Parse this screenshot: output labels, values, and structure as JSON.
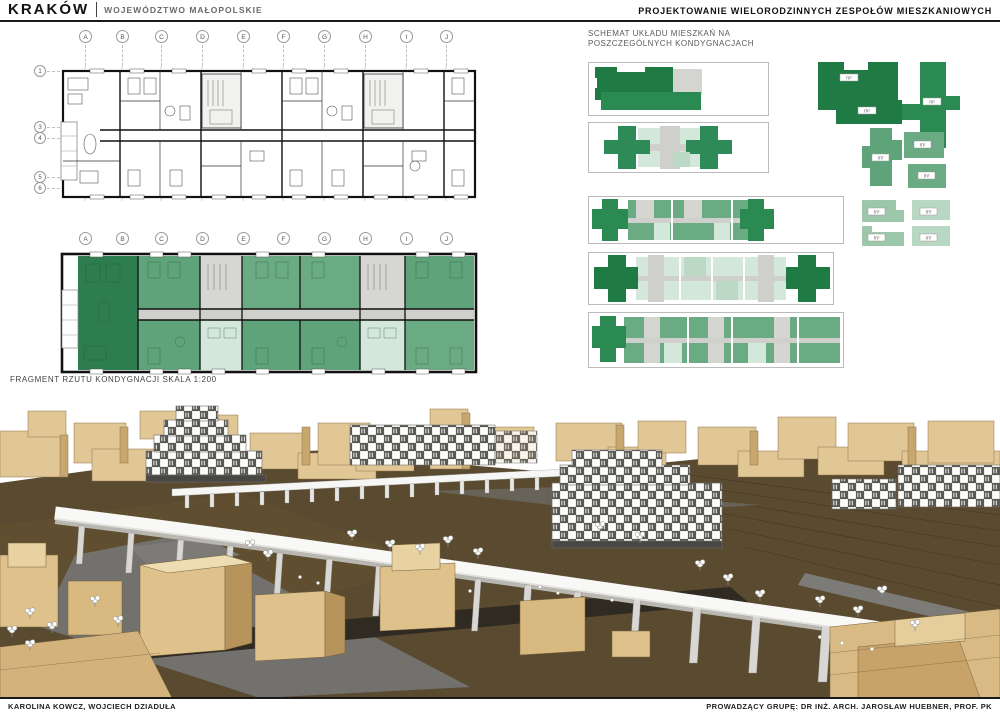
{
  "header": {
    "city": "KRAKÓW",
    "region": "WOJEWÓDZTWO MAŁOPOLSKIE",
    "course_title": "PROJEKTOWANIE WIELORODZINNYCH ZESPOŁÓW MIESZKANIOWYCH"
  },
  "plans": {
    "grid_columns": [
      "A",
      "B",
      "C",
      "D",
      "E",
      "F",
      "G",
      "H",
      "I",
      "J"
    ],
    "grid_rows": [
      "1",
      "3",
      "4",
      "5",
      "6"
    ],
    "caption": "FRAGMENT RZUTU KONDYGNACJI   SKALA 1:200"
  },
  "schematics": {
    "title_line1": "SCHEMAT UKŁADU MIESZKAŃ NA",
    "title_line2": "POSZCZEGÓLNYCH KONDYGNACJACH",
    "area_label": "m²"
  },
  "colors": {
    "dark_green": "#1f7a44",
    "mid_green": "#5fa37a",
    "light_green": "#d3e8da",
    "core_gray": "#d4d4d0",
    "tan_front": "#dfc18c",
    "tan_side": "#b6945c",
    "tan_top": "#eedcb2",
    "ground_brown": "#5a4a2f",
    "road_gray": "#72716d",
    "asphalt_dark": "#2f2a22",
    "walkway_white": "#f8f8f6"
  },
  "footer": {
    "authors": "KAROLINA KOWCZ, WOJCIECH DZIADUŁA",
    "supervisor": "PROWADZĄCY GRUPĘ:   DR INŻ. ARCH. JAROSŁAW HUEBNER, PROF. PK"
  }
}
